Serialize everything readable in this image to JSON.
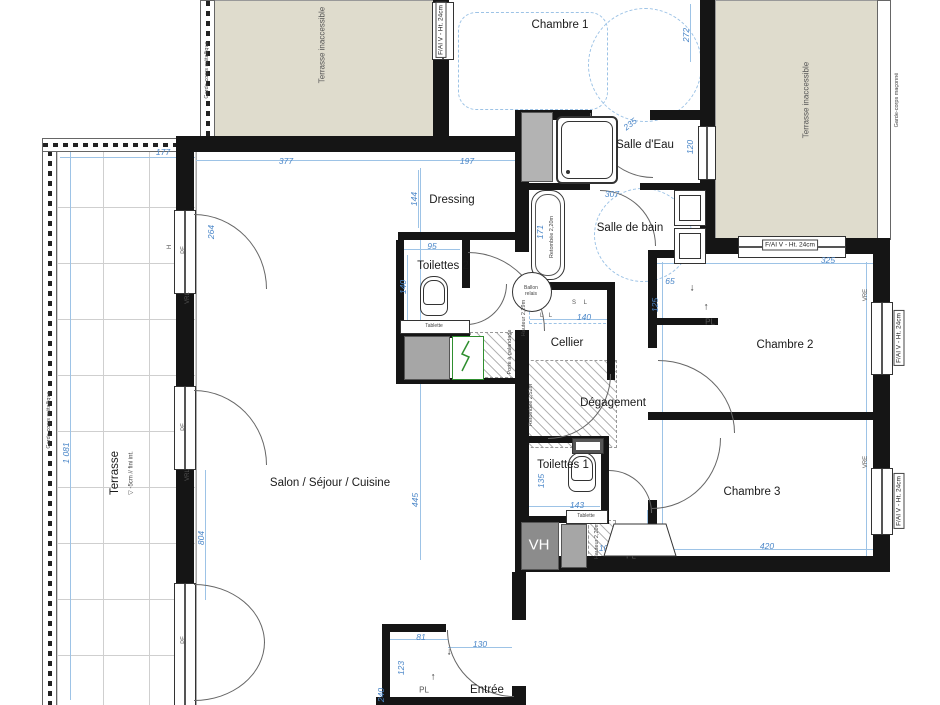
{
  "title": "Plan d'appartement 4 pièces",
  "colors": {
    "wall": "#151515",
    "dim_blue": "#4a86c8",
    "line_blue": "#9dc3e6",
    "terrace_texture": "#dfdccd",
    "duct_gray": "#a6a6a6",
    "panel_green": "#2f8f2f"
  },
  "window_tag": {
    "t": "F/AI V - Ht. 24cm"
  },
  "rooms": [
    {
      "label": "Chambre 1"
    },
    {
      "label": "Salle d'Eau"
    },
    {
      "label": "Salle de bain"
    },
    {
      "label": "Dressing"
    },
    {
      "label": "Toilettes 2"
    },
    {
      "label": "Cellier"
    },
    {
      "label": "Dégagement"
    },
    {
      "label": "Chambre 2"
    },
    {
      "label": "Toilettes 1"
    },
    {
      "label": "Chambre 3"
    },
    {
      "label": "Salon / Séjour / Cuisine"
    },
    {
      "label": "Entrée"
    },
    {
      "label": "Terrasse"
    },
    {
      "label": "Terrasse inaccessible"
    },
    {
      "label": "Terrasse inaccessible"
    }
  ],
  "dims": [
    {
      "t": "177"
    },
    {
      "t": "377"
    },
    {
      "t": "197"
    },
    {
      "t": "144"
    },
    {
      "t": "95"
    },
    {
      "t": "140"
    },
    {
      "t": "272"
    },
    {
      "t": "235"
    },
    {
      "t": "120"
    },
    {
      "t": "307"
    },
    {
      "t": "171"
    },
    {
      "t": "140"
    },
    {
      "t": "65"
    },
    {
      "t": "125"
    },
    {
      "t": "325"
    },
    {
      "t": "445"
    },
    {
      "t": "804"
    },
    {
      "t": "264"
    },
    {
      "t": "1 081"
    },
    {
      "t": "135"
    },
    {
      "t": "143"
    },
    {
      "t": "100"
    },
    {
      "t": "100"
    },
    {
      "t": "420"
    },
    {
      "t": "81"
    },
    {
      "t": "130"
    },
    {
      "t": "123"
    },
    {
      "t": "240"
    }
  ],
  "tiny": [
    {
      "t": "Garde-corps maçonné"
    },
    {
      "t": "Garde-corps métallique"
    },
    {
      "t": "Garde-corps métallique"
    },
    {
      "t": "Porte à galandage"
    },
    {
      "t": "Hauteur 2,29m"
    },
    {
      "t": "Retombée 2,52m"
    },
    {
      "t": "Retombée 2,20m"
    },
    {
      "t": "Hauteur 2,20m"
    },
    {
      "t": "Ballon relais"
    },
    {
      "t": "Tablette"
    },
    {
      "t": "Tablette"
    },
    {
      "t": "S L"
    },
    {
      "t": "L L"
    },
    {
      "t": "▽ -5cm // fini int."
    }
  ],
  "codes": [
    {
      "t": "PF"
    },
    {
      "t": "PF"
    },
    {
      "t": "PF"
    },
    {
      "t": "VRL"
    },
    {
      "t": "VRL"
    },
    {
      "t": "VRE"
    },
    {
      "t": "VRE"
    },
    {
      "t": "H"
    },
    {
      "t": "PL"
    },
    {
      "t": "PL"
    },
    {
      "t": "PL"
    },
    {
      "t": "VH"
    }
  ],
  "arrows": [
    {
      "t": "↓"
    },
    {
      "t": "↑"
    },
    {
      "t": "↓"
    },
    {
      "t": "↑"
    },
    {
      "t": "↑"
    }
  ]
}
